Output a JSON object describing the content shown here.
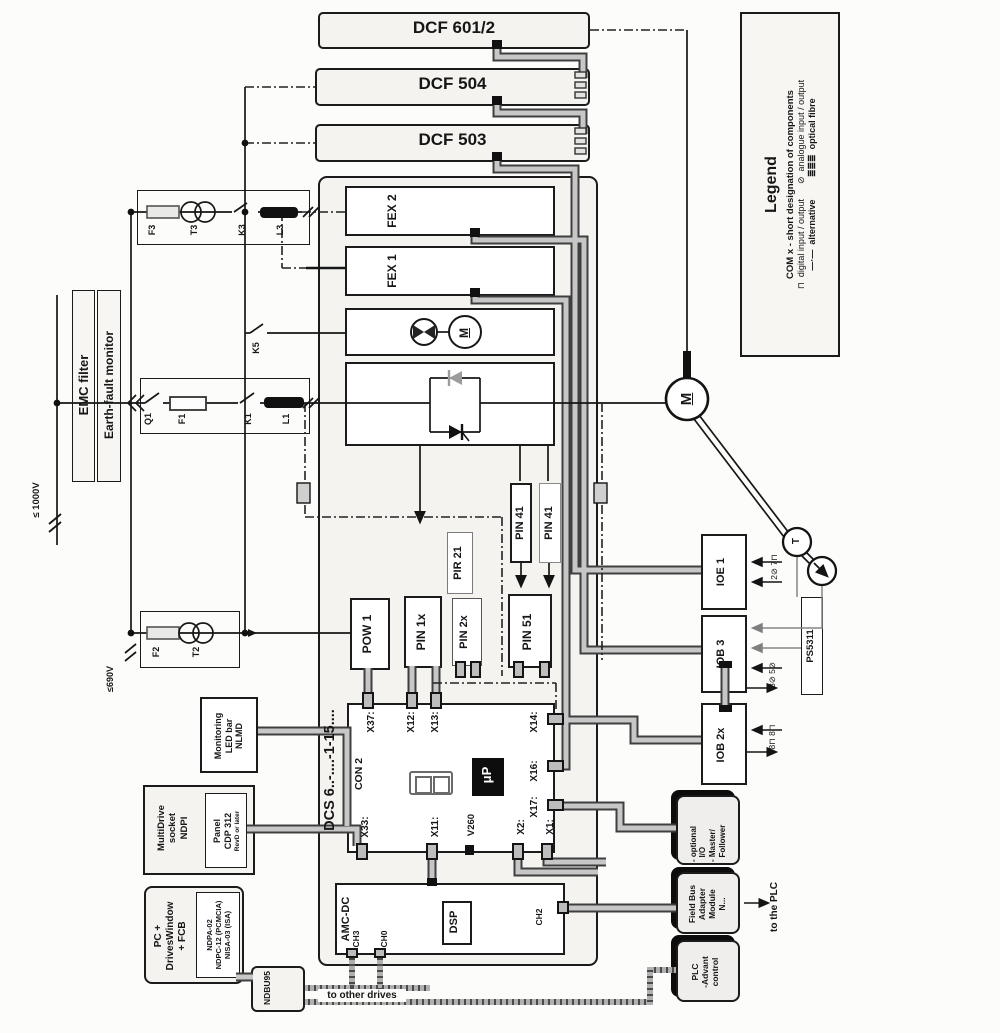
{
  "units": {
    "dcf6012": "DCF 601/2",
    "dcf504": "DCF 504",
    "dcf503": "DCF 503"
  },
  "legend": {
    "title": "Legend",
    "com": "COM x - short designation of components",
    "io_line": "⊓  digital input / output      ⊘  analogue input / output",
    "alt_line": "—·—  alternative         ≣≣≣  optical fibre"
  },
  "supply": {
    "emc": "EMC filter",
    "earth": "Earth-fault monitor",
    "v1000": "≤ 1000V",
    "v690": "≤690V"
  },
  "power_components": {
    "f3": "F3",
    "t3": "T3",
    "k3": "K3",
    "l3": "L3",
    "q1": "Q1",
    "f1": "F1",
    "k1": "K1",
    "l1": "L1",
    "k5": "K5",
    "f2": "F2",
    "t2": "T2"
  },
  "drive": {
    "model": "DCS 6..-....-1-15....",
    "fex2": "FEX 2",
    "fex1": "FEX 1",
    "fan_motor": "M",
    "pir21": "PIR 21",
    "pin41a": "PIN 41",
    "pin41b": "PIN 41",
    "pow1": "POW 1",
    "pin1x": "PIN 1x",
    "pin2x": "PIN 2x",
    "pin51": "PIN 51"
  },
  "board": {
    "con2": "CON 2",
    "cpu": "μP",
    "x37": "X37:",
    "x12": "X12:",
    "x13": "X13:",
    "x14": "X14:",
    "x16": "X16:",
    "x17": "X17:",
    "x33": "X33:",
    "x11": "X11:",
    "v260": "V260",
    "x2": "X2:",
    "x1": "X1:"
  },
  "amc": {
    "title": "AMC-DC",
    "ch3": "CH3",
    "ch0": "CH0",
    "dsp": "DSP",
    "ch2": "CH2"
  },
  "accessories": {
    "nlmd": [
      "Monitoring",
      "LED bar",
      "NLMD"
    ],
    "ndpi": [
      "MultiDrive",
      "socket",
      "NDPI"
    ],
    "panel": [
      "Panel",
      "CDP 312",
      "RevD or later"
    ],
    "pc": [
      "PC +",
      "DrivesWindow",
      "+ FCB"
    ],
    "cards": [
      "NDPA-02",
      "NDPC-12 (PCMCIA)",
      "NISA-03 (ISA)"
    ],
    "ndbu": "NDBU95",
    "to_other_drives": "to other drives"
  },
  "motor": {
    "label": "M",
    "tacho_t": "T"
  },
  "io": {
    "ioe1": "IOE 1",
    "iob3": "IOB 3",
    "iob2x": "IOB 2x",
    "ps5311": "PS5311",
    "ioe1_ch": "2⊘ 7⊓",
    "iob3_ch": "3⊘ 5⊘",
    "iob2x_ch": "8⊓ 8⊓"
  },
  "external": {
    "optional_io": [
      "- optional",
      "  I/O",
      "- Master/",
      "  Follower"
    ],
    "fieldbus": [
      "Field Bus",
      "Adapter",
      "Module",
      "N..."
    ],
    "plc": [
      "PLC",
      "-Advant",
      "control"
    ],
    "to_plc": "to the PLC"
  }
}
